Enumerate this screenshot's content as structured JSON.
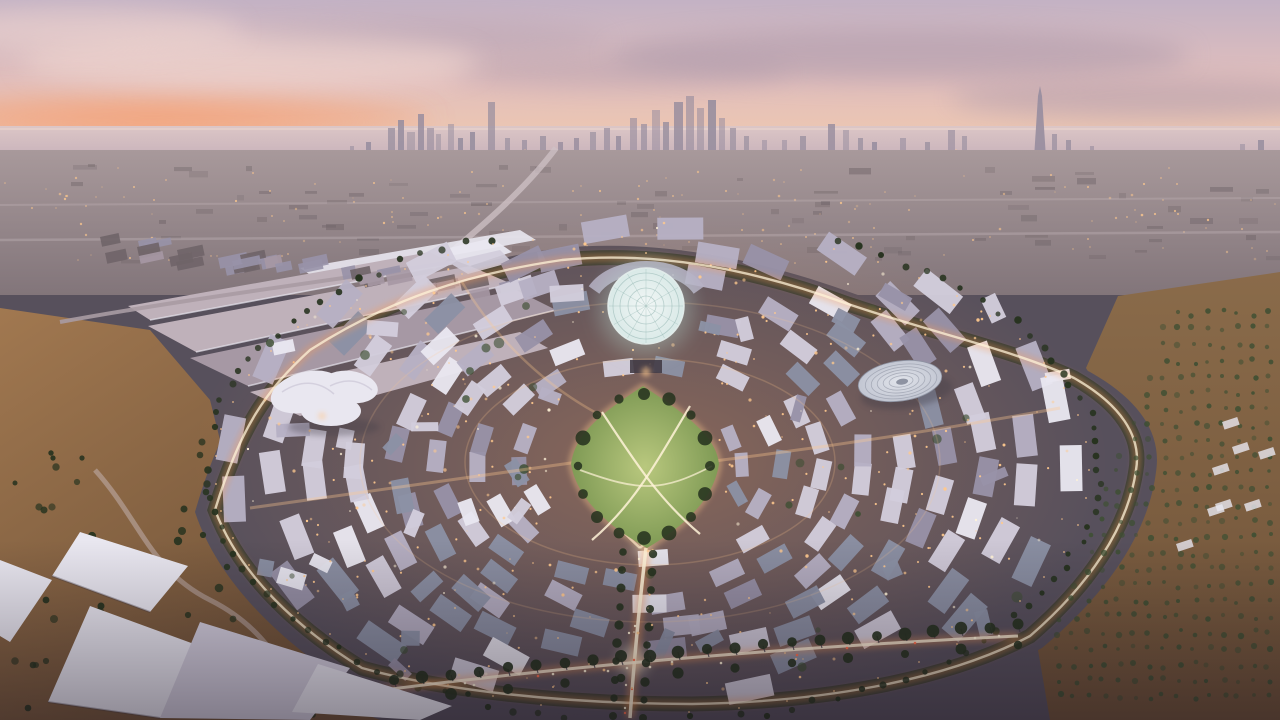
{
  "scene": {
    "title": "Aerial dusk rendering of a circular expo master plan with Dubai skyline on the horizon",
    "description": "Sunset aerial view of a large circular expo district: central glowing lattice dome, kite-shaped green park, disc-roof pavilion, trefoil white pavilion, long exhibition halls, rings of low-rise buildings with warm lights, palm-lined ring road and avenues, desert foreground, distant sea and skyscraper skyline under a pink sky",
    "time_of_day": "sunset",
    "landmarks": [
      "sunset-sky",
      "sea-horizon",
      "city-skyline",
      "burj-khalifa-tower",
      "city-sprawl",
      "expo-site",
      "al-wasl-dome",
      "central-park",
      "disc-roof-pavilion",
      "trefoil-pavilion",
      "exhibition-halls",
      "monorail-station",
      "ring-road",
      "main-avenue",
      "palm-boulevard",
      "desert-foreground",
      "white-canopy-roofs"
    ]
  },
  "colors": {
    "sky_top": "#c3b2c4",
    "sky_mid": "#e2bfbc",
    "sky_horizon": "#f0c9ae",
    "sunset_glow": "#f49f74",
    "cloud_dark": "#a795a8",
    "cloud_light": "#f3d9d2",
    "sea_top": "#dcc6c6",
    "sea_bottom": "#c9b3bb",
    "sea_sheen": "#f0dcd2",
    "skyline": "#978d9e",
    "sprawl_top": "#a8999b",
    "sprawl_bottom": "#82757a",
    "sprawl_block": "#6f6468",
    "site_ground": "#57505c",
    "tree_belt": "#2c3627",
    "tree_dark": "#27331f",
    "tree_mid": "#3e4f33",
    "roof_white": "#e9e7f0",
    "roof_light": "#d2cddc",
    "roof_mid": "#b6b0c4",
    "roof_dark": "#9892a8",
    "roof_slate": "#8b91a4",
    "hall_roof": "#bfb1ba",
    "hall_roof_dark": "#a698a4",
    "warm_light": "#ffc98e",
    "warm_glow": "#ff9d55",
    "bright_light": "#fff3d8",
    "car_tail": "#ff6f4d",
    "road_light": "#cfc2c6",
    "road_dark": "#433c46",
    "sand_left": "#a17850",
    "sand_dark": "#6f5238",
    "sand_right": "#8a6b4a",
    "park_green": "#7f9a55",
    "park_light": "#b9c87e",
    "dome_top": "#f2f7f6",
    "dome_shell": "#d9e9e7",
    "dome_lattice": "#8fb3ae",
    "dome_glow": "#bfe5da",
    "disc_roof": "#e1e4eb",
    "disc_edge": "#c2c6d2",
    "disc_ring": "#8e93a2",
    "metro_line": "#a89ba3",
    "vignette": "#140d1a"
  }
}
